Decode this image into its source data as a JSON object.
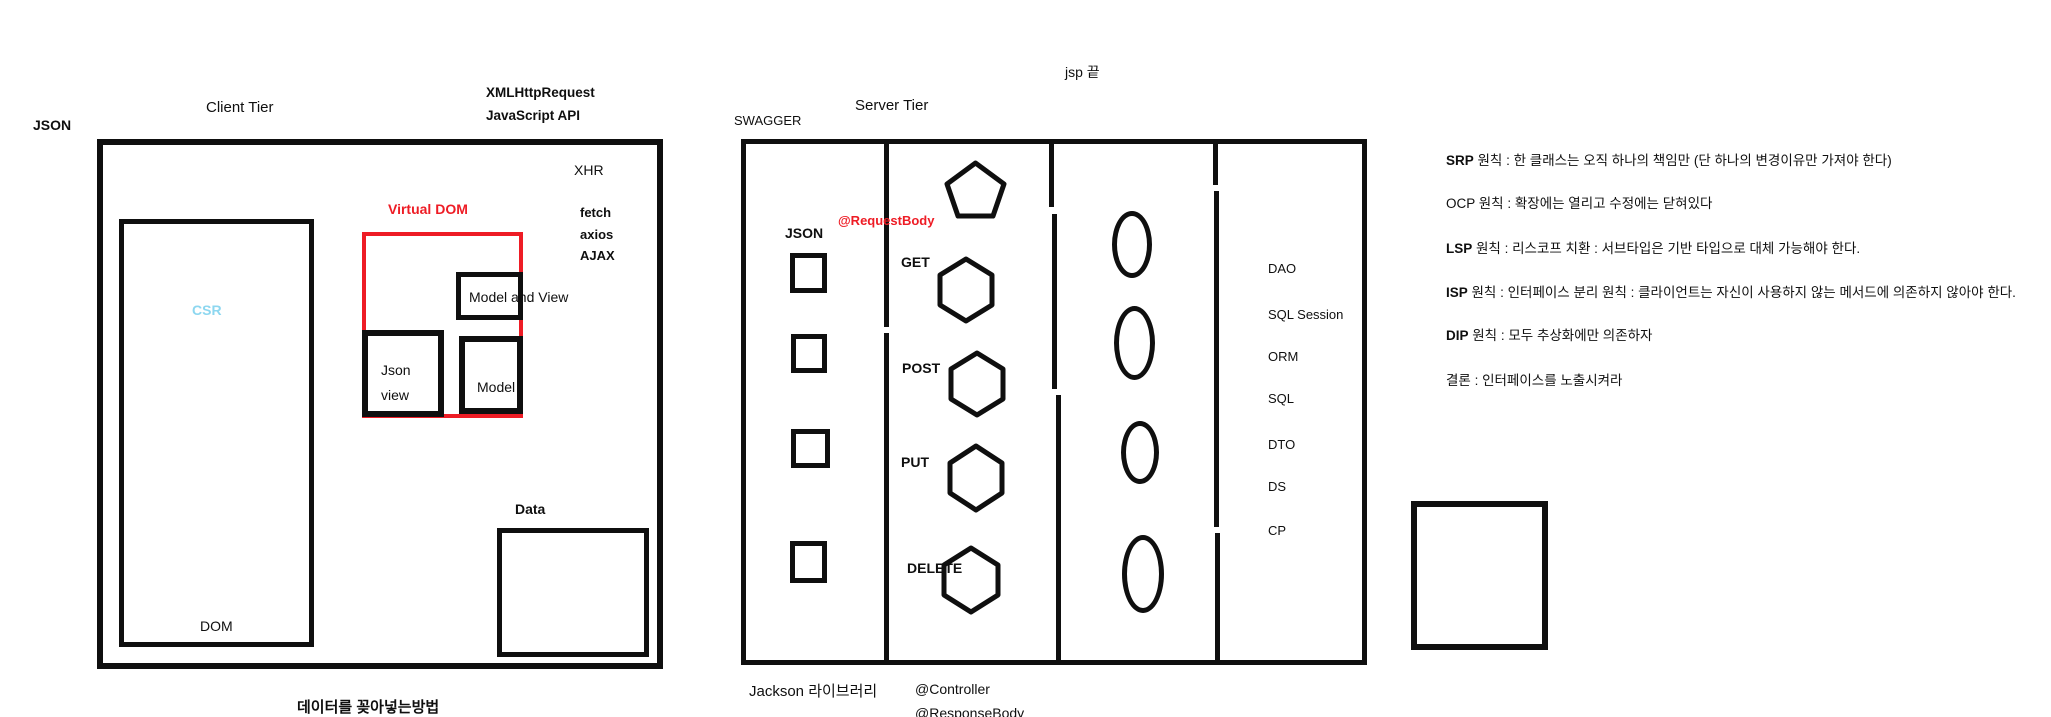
{
  "canvas": {
    "width": 2051,
    "height": 717
  },
  "colors": {
    "ink": "#0f0f0f",
    "accent_red": "#ee1c25",
    "csr_blue": "#8dd7f0"
  },
  "client": {
    "json_label": "JSON",
    "title": "Client Tier",
    "xml_line1": "XMLHttpRequest",
    "xml_line2": "JavaScript API",
    "xhr": "XHR",
    "fetch": "fetch",
    "axios": "axios",
    "ajax": "AJAX",
    "virtual_dom": "Virtual DOM",
    "csr": "CSR",
    "dom": "DOM",
    "model_and_view": "Model and View",
    "json_view_line1": "Json",
    "json_view_line2": "view",
    "model": "Model",
    "data_label": "Data",
    "caption": "데이터를 꽂아넣는방법"
  },
  "server": {
    "swagger": "SWAGGER",
    "title": "Server Tier",
    "jsp_note": "jsp 끝",
    "json_label": "JSON",
    "request_body": "@RequestBody",
    "methods": [
      "GET",
      "POST",
      "PUT",
      "DELETE"
    ],
    "dao_stack": [
      "DAO",
      "SQL Session",
      "ORM",
      "SQL",
      "DTO",
      "DS",
      "CP"
    ],
    "jackson": "Jackson 라이브러리",
    "controller": "@Controller",
    "response_body": "@ResponseBody",
    "shapes": {
      "pentagon_count": 1,
      "hexagon_count": 4,
      "square_count": 4,
      "ellipse_count": 4
    }
  },
  "principles": {
    "lines": [
      {
        "acronym": "SRP",
        "rest": " 원칙 : 한 클래스는 오직 하나의 책임만 (단 하나의 변경이유만 가져야 한다)"
      },
      {
        "acronym": "OCP",
        "rest": " 원칙 : 확장에는 열리고 수정에는 닫혀있다"
      },
      {
        "acronym": "LSP",
        "rest": " 원칙 : 리스코프 치환 :  서브타입은 기반 타입으로 대체 가능해야 한다."
      },
      {
        "acronym": "ISP",
        "rest": " 원칙 : 인터페이스 분리 원칙 : 클라이언트는 자신이 사용하지 않는 메서드에 의존하지 않아야 한다."
      },
      {
        "acronym": "DIP",
        "rest": " 원칙 : 모두 추상화에만 의존하자"
      },
      {
        "acronym": "결론",
        "rest": " : 인터페이스를 노출시켜라"
      }
    ]
  }
}
